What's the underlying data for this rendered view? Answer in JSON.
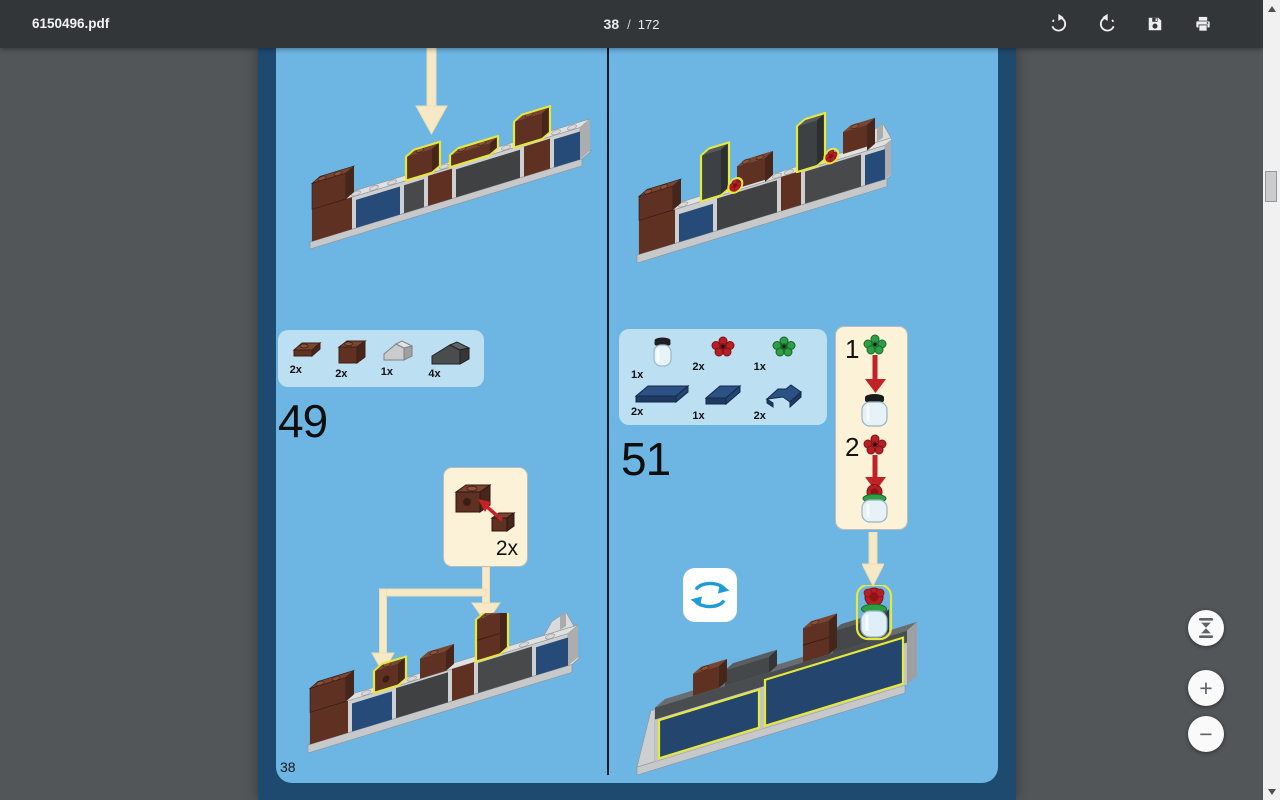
{
  "toolbar": {
    "filename": "6150496.pdf",
    "page_current": "38",
    "page_separator": "/",
    "page_total": "172",
    "buttons": [
      "rotate-clockwise",
      "rotate-counterclockwise",
      "save",
      "print"
    ]
  },
  "controls": {
    "fit": "fit-to-page",
    "zoom_in": "+",
    "zoom_out": "−"
  },
  "doc": {
    "page_label": "38",
    "step49": {
      "number": "49",
      "parts": [
        {
          "name": "reddish-brown-plate-1x1",
          "count": "2x"
        },
        {
          "name": "reddish-brown-brick-1x1",
          "count": "2x"
        },
        {
          "name": "light-gray-slope",
          "count": "1x"
        },
        {
          "name": "dark-gray-slope",
          "count": "4x"
        }
      ],
      "callout_count": "2x"
    },
    "step51": {
      "number": "51",
      "parts_top": [
        {
          "name": "clear-jar",
          "count": "1x"
        },
        {
          "name": "red-flower-plate",
          "count": "2x"
        },
        {
          "name": "green-flower-plate",
          "count": "1x"
        }
      ],
      "parts_bottom": [
        {
          "name": "dark-blue-tile-1x4",
          "count": "2x"
        },
        {
          "name": "dark-blue-tile-2x2",
          "count": "1x"
        },
        {
          "name": "dark-blue-corner-tile",
          "count": "2x"
        }
      ],
      "substeps": [
        {
          "label": "1"
        },
        {
          "label": "2"
        }
      ]
    }
  },
  "colors": {
    "toolbar_bg": "#323639",
    "viewer_bg": "#525659",
    "page_navy": "#1F4A6F",
    "page_blue": "#6DB5E3",
    "parts_box_blue": "#BCDFF2",
    "callout_cream": "#FBF2D7",
    "highlight_yellow": "#E6E83B",
    "arrow_cream": "#F7E9C6",
    "arrow_red": "#C42127",
    "rotate_blue": "#1E9CD7"
  }
}
